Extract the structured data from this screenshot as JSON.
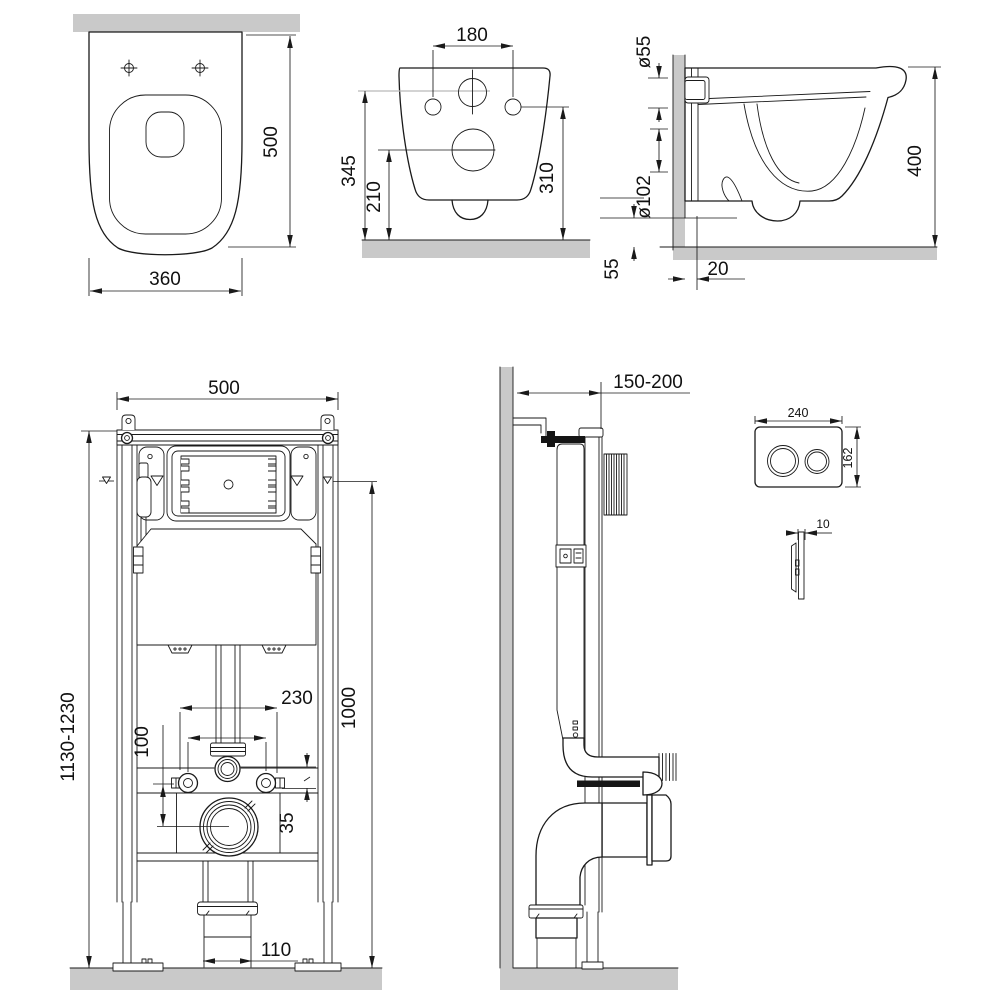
{
  "drawing": {
    "kind": "technical dimensional drawing",
    "subject": "wall-hung toilet with concealed installation frame and flush plate",
    "units": "mm",
    "colors": {
      "line": "#1a1a1a",
      "wall_fill": "#c9c9c9",
      "background": "#ffffff"
    }
  },
  "views": {
    "toilet_top": {
      "label": "toilet top view",
      "dim_depth": "500",
      "dim_width": "360"
    },
    "toilet_back": {
      "label": "toilet back view",
      "dim_bolt_spacing": "180",
      "dim_inlet_height": "345",
      "dim_outlet_height": "210",
      "dim_bolt_height": "310"
    },
    "toilet_side": {
      "label": "toilet side view",
      "dim_inlet_dia": "ø55",
      "dim_outlet_dia": "ø102",
      "dim_height": "400",
      "dim_outlet_offset": "55",
      "dim_wall_gap": "20"
    },
    "frame_front": {
      "label": "installation frame front view",
      "dim_width": "500",
      "dim_height_range": "1130-1230",
      "dim_flush_axis": "1000",
      "dim_spacing": "230",
      "dim_offset": "100",
      "dim_axis_gap": "35",
      "dim_pipe": "110"
    },
    "frame_side": {
      "label": "installation frame side view",
      "dim_depth_range": "150-200"
    },
    "flush_plate": {
      "label": "flush plate",
      "dim_width": "240",
      "dim_height": "162",
      "dim_thickness": "10"
    }
  }
}
